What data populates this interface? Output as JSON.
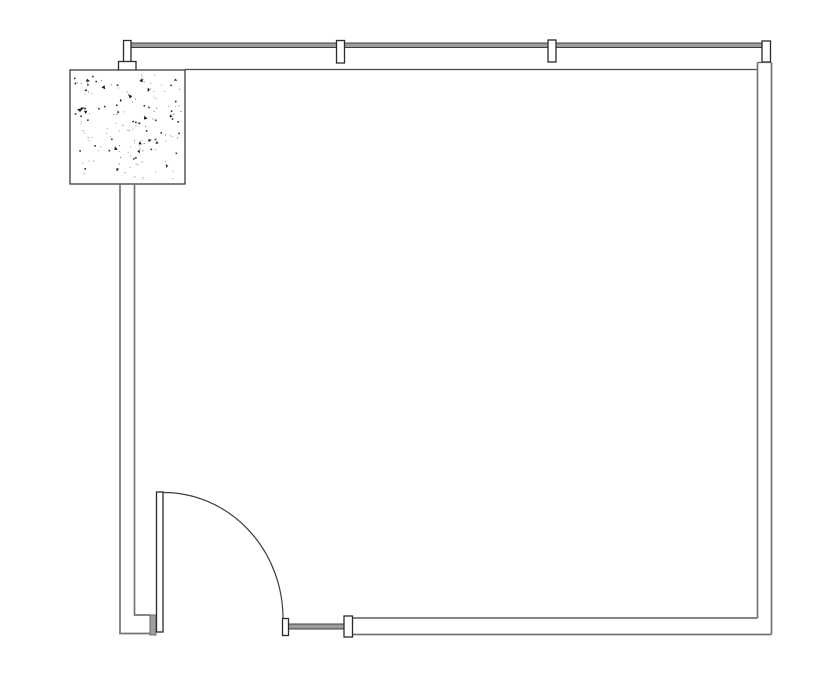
{
  "drawing": {
    "kind": "architectural-floor-plan",
    "canvas": {
      "width": 835,
      "height": 678,
      "background": "#ffffff"
    },
    "colors": {
      "wall_line": "#757575",
      "thin_line": "#4a4a4a",
      "dark_outline": "#2b2b2b",
      "glazing_fill": "#9e9e9e",
      "glazing_edge": "#3f3f3f",
      "jamb_fill": "#9e9e9e",
      "white": "#ffffff",
      "stipple_dark": "#1c1c1c",
      "stipple_light": "#9a9a9a"
    },
    "elements": [
      {
        "name": "top-glazing-band",
        "type": "rect",
        "x": 128,
        "y": 43,
        "w": 634,
        "h": 4.5,
        "fill": "#9e9e9e",
        "stroke": "#3f3f3f",
        "sw": 1
      },
      {
        "name": "top-interior-wall-line",
        "type": "line",
        "x1": 185,
        "y1": 69.5,
        "x2": 757.5,
        "y2": 69.5,
        "stroke": "#4a4a4a",
        "sw": 1.2
      },
      {
        "name": "window-mullion-1",
        "type": "rect",
        "x": 123.5,
        "y": 40.5,
        "w": 7.5,
        "h": 21.5,
        "fill": "#ffffff",
        "stroke": "#2b2b2b",
        "sw": 1.3
      },
      {
        "name": "window-mullion-1-cap",
        "type": "rect",
        "x": 118.5,
        "y": 61.5,
        "w": 17.5,
        "h": 9,
        "fill": "#ffffff",
        "stroke": "#2b2b2b",
        "sw": 1.3
      },
      {
        "name": "window-mullion-2",
        "type": "rect",
        "x": 336.5,
        "y": 40.5,
        "w": 8,
        "h": 22.5,
        "fill": "#ffffff",
        "stroke": "#2b2b2b",
        "sw": 1.3
      },
      {
        "name": "window-mullion-3",
        "type": "rect",
        "x": 548,
        "y": 40,
        "w": 8,
        "h": 22,
        "fill": "#ffffff",
        "stroke": "#2b2b2b",
        "sw": 1.3
      },
      {
        "name": "window-mullion-4",
        "type": "rect",
        "x": 762,
        "y": 41,
        "w": 8.5,
        "h": 21,
        "fill": "#ffffff",
        "stroke": "#2b2b2b",
        "sw": 1.3
      },
      {
        "name": "concrete-column",
        "type": "rect",
        "x": 70,
        "y": 70,
        "w": 115,
        "h": 114,
        "fill": "#ffffff",
        "stroke": "#2b2b2b",
        "sw": 1.2,
        "stipple": {
          "seed": 11,
          "small_count": 95,
          "medium_count": 32,
          "large_count": 26,
          "margin": 4
        }
      },
      {
        "name": "left-wall-outer-line",
        "type": "polyline",
        "points": [
          [
            120,
            184
          ],
          [
            120,
            633.5
          ],
          [
            150,
            633.5
          ]
        ],
        "stroke": "#757575",
        "sw": 1.7
      },
      {
        "name": "left-wall-inner-line",
        "type": "polyline",
        "points": [
          [
            134.5,
            184
          ],
          [
            134.5,
            615
          ],
          [
            150,
            615
          ]
        ],
        "stroke": "#757575",
        "sw": 1.7
      },
      {
        "name": "right-wall-top-cap",
        "type": "line",
        "x1": 757.5,
        "y1": 62.5,
        "x2": 771.5,
        "y2": 62.5,
        "stroke": "#555555",
        "sw": 1.2
      },
      {
        "name": "right-wall-inner-line",
        "type": "line",
        "x1": 757.5,
        "y1": 62.5,
        "x2": 757.5,
        "y2": 618,
        "stroke": "#757575",
        "sw": 1.7
      },
      {
        "name": "right-wall-outer-line",
        "type": "line",
        "x1": 771.5,
        "y1": 62.5,
        "x2": 771.5,
        "y2": 634.5,
        "stroke": "#757575",
        "sw": 1.7
      },
      {
        "name": "bottom-wall-inner-line",
        "type": "line",
        "x1": 352.5,
        "y1": 618,
        "x2": 757.5,
        "y2": 618,
        "stroke": "#757575",
        "sw": 1.7
      },
      {
        "name": "bottom-wall-outer-line",
        "type": "line",
        "x1": 352.5,
        "y1": 634.5,
        "x2": 771.5,
        "y2": 634.5,
        "stroke": "#757575",
        "sw": 1.7
      },
      {
        "name": "bottom-sidelight-band",
        "type": "rect",
        "x": 288.5,
        "y": 624,
        "w": 55.5,
        "h": 5,
        "fill": "#9e9e9e",
        "stroke": "#3f3f3f",
        "sw": 1
      },
      {
        "name": "bottom-wall-end-mullion",
        "type": "rect",
        "x": 344,
        "y": 616,
        "w": 8.5,
        "h": 21,
        "fill": "#ffffff",
        "stroke": "#2b2b2b",
        "sw": 1.3
      },
      {
        "name": "door-strike-jamb",
        "type": "rect",
        "x": 282.5,
        "y": 618.5,
        "w": 6,
        "h": 17,
        "fill": "#ffffff",
        "stroke": "#2b2b2b",
        "sw": 1.3
      },
      {
        "name": "door-hinge-jamb",
        "type": "rect",
        "x": 150,
        "y": 615,
        "w": 6,
        "h": 20,
        "fill": "#9e9e9e",
        "stroke": "#6a6a6a",
        "sw": 1
      },
      {
        "name": "door-leaf",
        "type": "rect",
        "x": 156.5,
        "y": 492,
        "w": 6.5,
        "h": 140,
        "fill": "#ffffff",
        "stroke": "#2b2b2b",
        "sw": 1.3
      },
      {
        "name": "door-swing-arc",
        "type": "arc",
        "x1": 163.5,
        "y1": 492.5,
        "rx": 119.5,
        "ry": 126,
        "x2": 283,
        "y2": 618.5,
        "stroke": "#3f3f3f",
        "sw": 1.2
      }
    ]
  }
}
